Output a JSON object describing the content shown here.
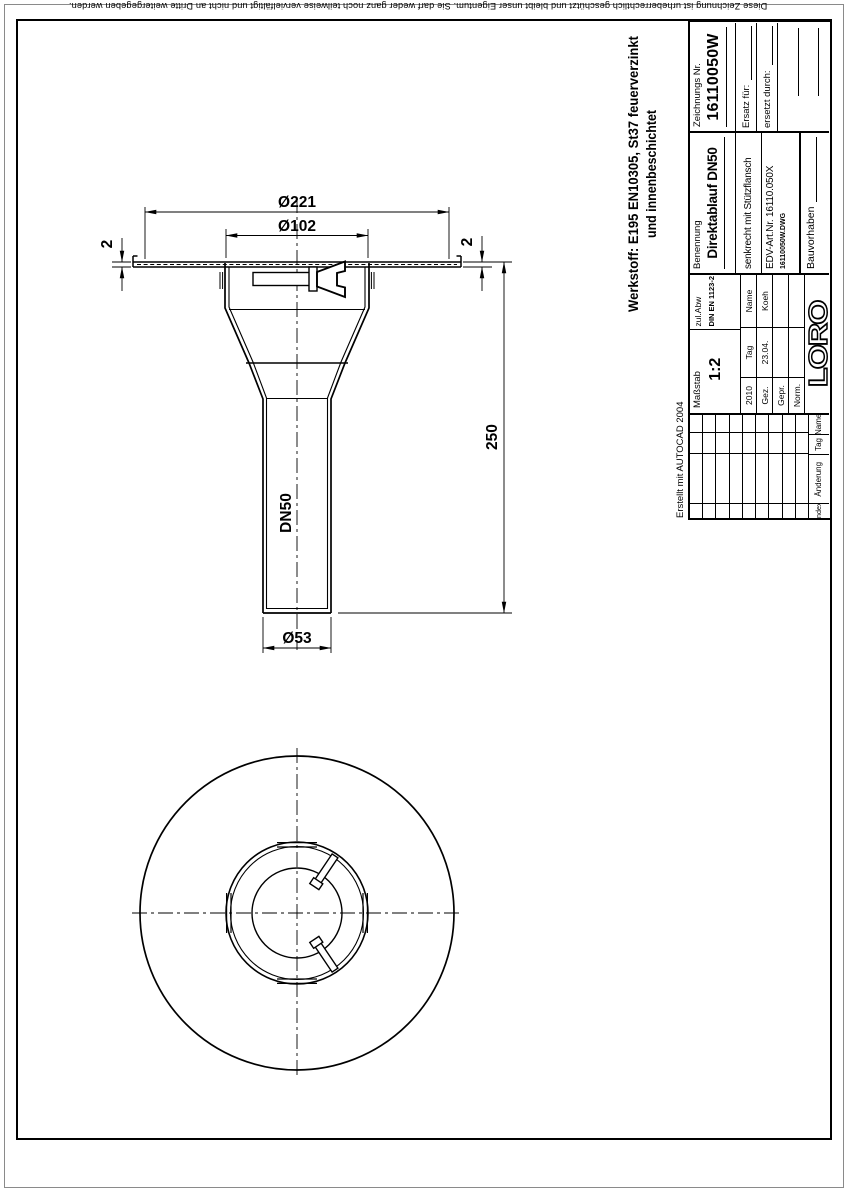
{
  "page": {
    "background": "#ffffff",
    "line_color": "#000000",
    "outer_border_color": "#8a8a8a"
  },
  "disclaimer": "Diese Zeichnung ist urheberrechtlich geschützt und bleibt unser Eigentum. Sie darf weder ganz noch teilweise vervielfältigt und nicht an Dritte weitergegeben werden.",
  "autocad_note": "Erstellt mit AUTOCAD 2004",
  "material": {
    "line1": "Werkstoff:  E195 EN10305, St37 feuerverzinkt",
    "line2": "und innenbeschichtet"
  },
  "dimensions": {
    "flange_dia": "Ø221",
    "bowl_dia": "Ø102",
    "flange_thickness_left": "2",
    "flange_thickness_right": "2",
    "pipe_length": "250",
    "pipe_label": "DN50",
    "pipe_dia": "Ø53"
  },
  "title_block": {
    "drawing_no_label": "Zeichnungs Nr.",
    "drawing_no": "16110050W",
    "replacement_for_label": "Ersatz für:",
    "replaced_by_label": "ersetzt durch:",
    "name_label": "Benennung",
    "name": "Direktablauf DN50",
    "name_sub": "senkrecht mit Stützflansch",
    "edv_art_nr": "EDV-Art.Nr. 16110.050X",
    "file_name": "16110050W.DWG",
    "project_label": "Bauvorhaben",
    "scale_label": "Maßstab",
    "scale": "1:2",
    "tolerance_label": "zul.Abw",
    "tolerance_norm": "DIN EN 1123-2",
    "year": "2010",
    "day_label": "Tag",
    "name_col_label": "Name",
    "drawn_label": "Gez.",
    "checked_label": "Gepr.",
    "norm_label": "Norm.",
    "drawn_date": "23.04.",
    "drawn_name": "Koeh",
    "logo": "LORO",
    "revision": {
      "index_label": "Index",
      "change_label": "Änderung",
      "day_label": "Tag",
      "name_label": "Name"
    }
  }
}
